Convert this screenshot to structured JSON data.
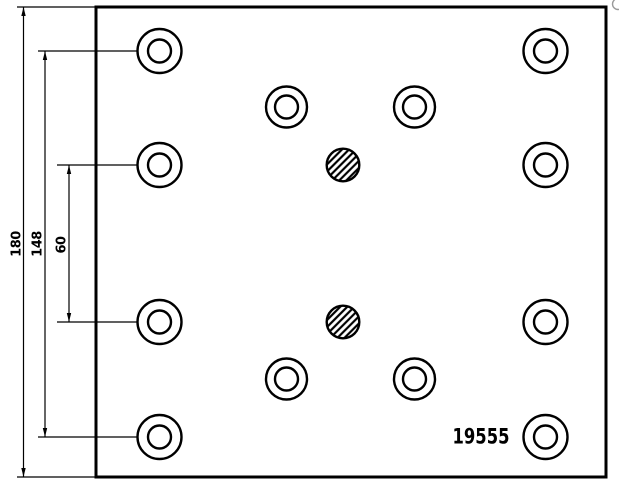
{
  "drawing": {
    "part_number": "19555",
    "colors": {
      "line": "#000000",
      "background": "#ffffff",
      "watermark": "#9a9a9a"
    },
    "canvas": {
      "width": 619,
      "height": 490
    },
    "plate": {
      "x": 96,
      "y": 7,
      "width": 510,
      "height": 470,
      "stroke_width": 3
    },
    "dimensions": [
      {
        "label": "180",
        "line_x": 23.5,
        "y1": 7,
        "y2": 477,
        "label_cx": 16.5,
        "label_cy": 244
      },
      {
        "label": "148",
        "line_x": 45,
        "y1": 51,
        "y2": 437,
        "label_cx": 37.5,
        "label_cy": 243.5
      },
      {
        "label": "60",
        "line_x": 69,
        "y1": 165,
        "y2": 322,
        "label_cx": 61.5,
        "label_cy": 244.5
      }
    ],
    "extension_lines": [
      {
        "x1": 17,
        "y1": 7,
        "x2": 96,
        "y2": 7
      },
      {
        "x1": 17,
        "y1": 477,
        "x2": 96,
        "y2": 477
      },
      {
        "x1": 38,
        "y1": 51,
        "x2": 138,
        "y2": 51
      },
      {
        "x1": 38,
        "y1": 437,
        "x2": 138,
        "y2": 437
      },
      {
        "x1": 57,
        "y1": 165,
        "x2": 138,
        "y2": 165
      },
      {
        "x1": 57,
        "y1": 322,
        "x2": 138,
        "y2": 322
      }
    ],
    "ring_holes": [
      {
        "cx": 159.5,
        "cy": 51,
        "r_outer": 22,
        "r_inner": 11.5
      },
      {
        "cx": 545.5,
        "cy": 51,
        "r_outer": 22,
        "r_inner": 11.5
      },
      {
        "cx": 286.5,
        "cy": 107,
        "r_outer": 20.5,
        "r_inner": 11.5
      },
      {
        "cx": 414.5,
        "cy": 107,
        "r_outer": 20.5,
        "r_inner": 11.5
      },
      {
        "cx": 159.5,
        "cy": 165,
        "r_outer": 22,
        "r_inner": 11.5
      },
      {
        "cx": 545.5,
        "cy": 165,
        "r_outer": 22,
        "r_inner": 11.5
      },
      {
        "cx": 159.5,
        "cy": 322,
        "r_outer": 22,
        "r_inner": 11.5
      },
      {
        "cx": 545.5,
        "cy": 322,
        "r_outer": 22,
        "r_inner": 11.5
      },
      {
        "cx": 286.5,
        "cy": 379,
        "r_outer": 20.5,
        "r_inner": 11.5
      },
      {
        "cx": 414.5,
        "cy": 379,
        "r_outer": 20.5,
        "r_inner": 11.5
      },
      {
        "cx": 159.5,
        "cy": 437,
        "r_outer": 22,
        "r_inner": 11.5
      },
      {
        "cx": 545.5,
        "cy": 437,
        "r_outer": 22,
        "r_inner": 11.5
      }
    ],
    "hatched_holes": [
      {
        "cx": 343,
        "cy": 165,
        "r": 16.3
      },
      {
        "cx": 343,
        "cy": 322,
        "r": 16.3
      }
    ],
    "part_number_pos": {
      "cx": 481,
      "cy": 437
    },
    "stroke": {
      "circle": 2.4,
      "plate": 3,
      "dim": 1.2,
      "hatch_width": 2.2,
      "hatch_spacing": 5,
      "arrow_len": 9,
      "arrow_half_w": 2.2
    }
  }
}
